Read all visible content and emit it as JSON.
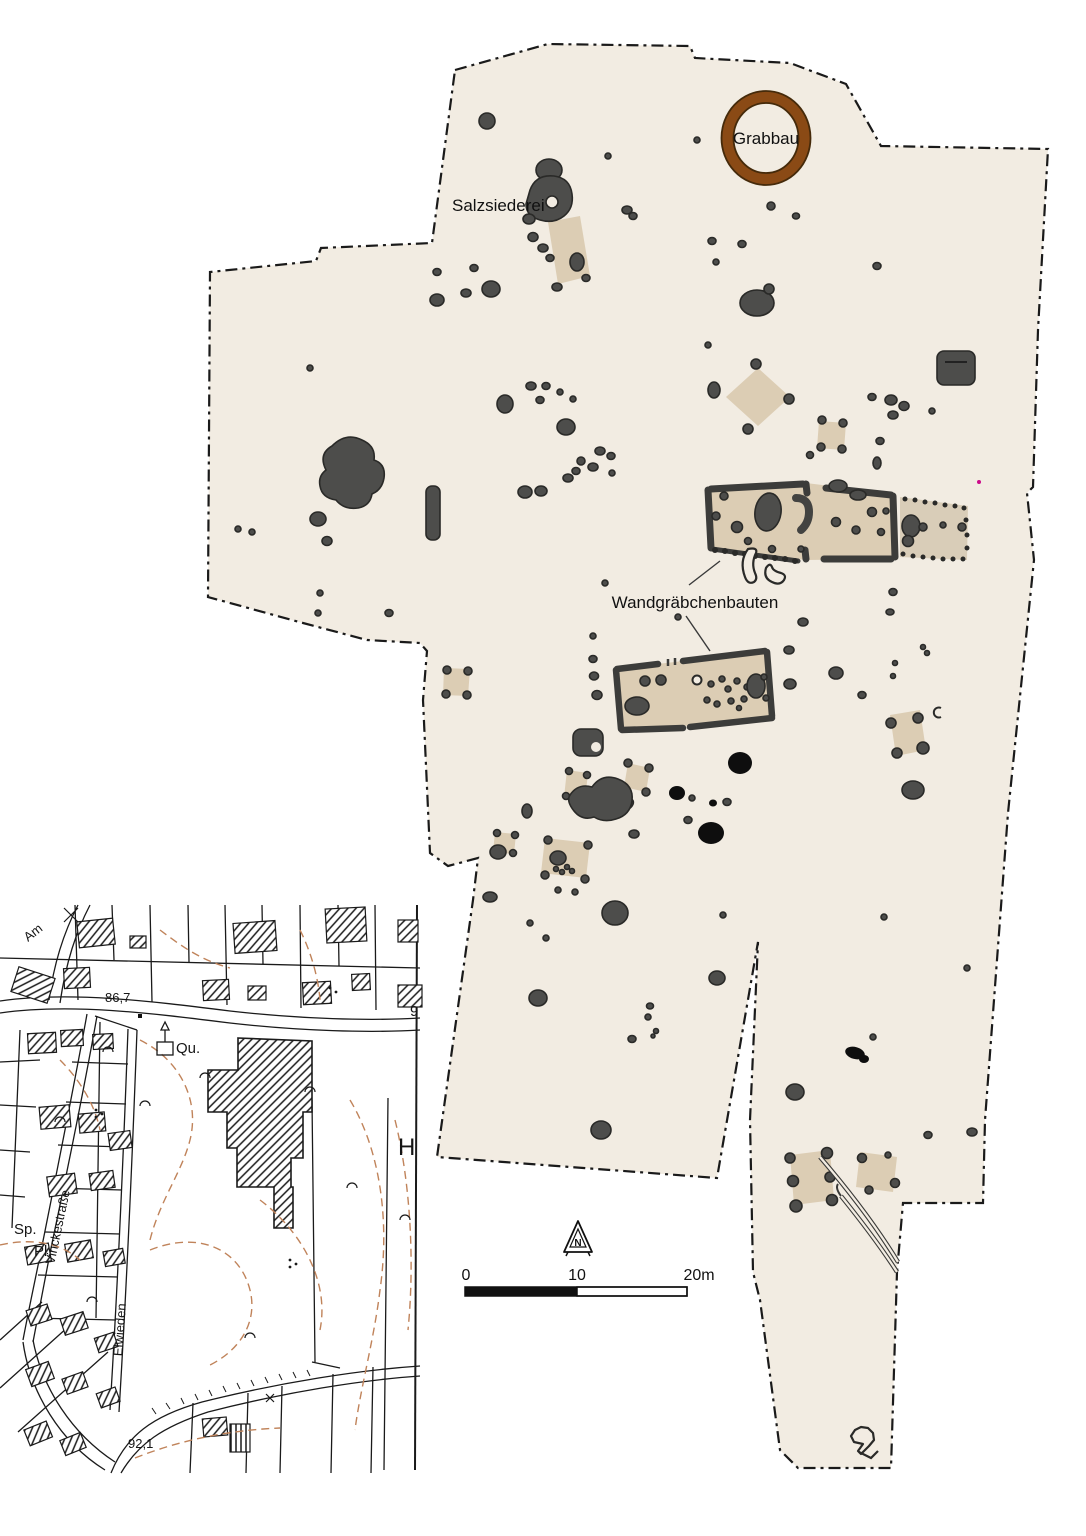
{
  "figure": {
    "labels": {
      "grabbau": "Grabbau",
      "salzsiederei": "Salzsiederei",
      "wandgraebchenbauten": "Wandgräbchenbauten"
    },
    "north_arrow_letter": "N",
    "scale_bar": {
      "start": "0",
      "middle": "10",
      "end": "20m"
    },
    "inset_map": {
      "street_names": {
        "am": "Am",
        "vinckestrasse": "Vinckestraße",
        "elwieden": "Elwieden"
      },
      "labels": {
        "qu": "Qu.",
        "sp": "Sp.",
        "pl": "Pl.",
        "h": "H",
        "nine": "9"
      },
      "elevations": {
        "point_86_7": "86,7",
        "point_92_1": "92,1"
      }
    },
    "colors": {
      "page_bg": "#ffffff",
      "excavation_fill": "#f2ece2",
      "feature_gray": "#4d4d4b",
      "feature_outline": "#2a2a28",
      "feature_black": "#0e0e0e",
      "building_tan": "#dccdb4",
      "building_tan_light": "#d9cdb8",
      "trench_gray": "#3c3c3a",
      "grabbau_brown": "#8a4a15",
      "grabbau_edge": "#452a0a",
      "contour_tan": "#c0835a",
      "line_black": "#1a1a1a",
      "magenta_dot": "#cc0a8a"
    }
  }
}
